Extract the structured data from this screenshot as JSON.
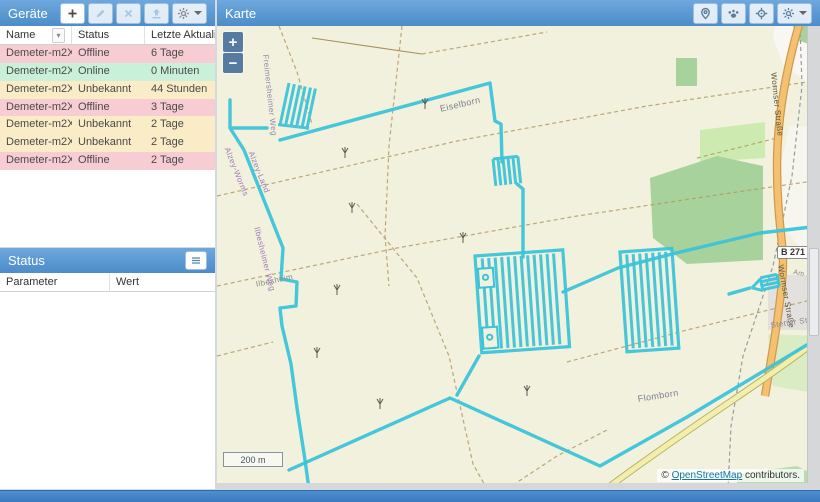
{
  "devices_panel": {
    "title": "Geräte",
    "columns": {
      "name": "Name",
      "status": "Status",
      "updated": "Letzte Aktualisie..."
    },
    "rows": [
      {
        "name": "Demeter-m2Xper...",
        "status": "Offline",
        "updated": "6 Tage"
      },
      {
        "name": "Demeter-m2Xper...",
        "status": "Online",
        "updated": "0 Minuten"
      },
      {
        "name": "Demeter-m2Xper...",
        "status": "Unbekannt",
        "updated": "44 Stunden"
      },
      {
        "name": "Demeter-m2Xper...",
        "status": "Offline",
        "updated": "3 Tage"
      },
      {
        "name": "Demeter-m2Xper...",
        "status": "Unbekannt",
        "updated": "2 Tage"
      },
      {
        "name": "Demeter-m2Xper...",
        "status": "Unbekannt",
        "updated": "2 Tage"
      },
      {
        "name": "Demeter-m2Xper...",
        "status": "Offline",
        "updated": "2 Tage"
      }
    ],
    "status_colors": {
      "Offline": "#f7ccd2",
      "Online": "#c9f0d8",
      "Unbekannt": "#f9ecc7"
    },
    "toolbar_icons": [
      "plus-icon",
      "pencil-icon",
      "close-icon",
      "upload-icon",
      "gear-icon"
    ]
  },
  "status_panel": {
    "title": "Status",
    "columns": {
      "parameter": "Parameter",
      "value": "Wert"
    },
    "rows": [],
    "header_icon": "list-icon"
  },
  "map_panel": {
    "title": "Karte",
    "toolbar_icons": [
      "marker-icon",
      "paw-icon",
      "crosshair-icon",
      "gear-icon"
    ],
    "controls": {
      "zoom_in": "+",
      "zoom_out": "−"
    },
    "scale_label": "200 m",
    "attribution": {
      "copyright": "© ",
      "link": "OpenStreetMap",
      "suffix": " contributors."
    },
    "labels": {
      "eiselborn": "Eiselborn",
      "freimersheimer_weg": "Freimersheimer Weg",
      "alzey_worms": "Alzey-Worms",
      "alzey_land": "Alzey-Land",
      "ilbesheimer_weg": "Ilbesheimer Weg",
      "ilbesheim": "Ilbesheim",
      "flomborn": "Flomborn",
      "wormser_strasse_1": "Wormser Straße",
      "wormser_strasse_2": "Wormser Straße",
      "am_feuer": "Am Feuer",
      "stetter": "Stetter Str.",
      "b271": "B 271"
    },
    "colors": {
      "track": "#3cc3d8",
      "farmland": "#f1f1de",
      "forest": "#a8d29b",
      "road_primary": "#f3c170",
      "road_secondary": "#f2efae",
      "residential": "#e3e1de"
    }
  }
}
